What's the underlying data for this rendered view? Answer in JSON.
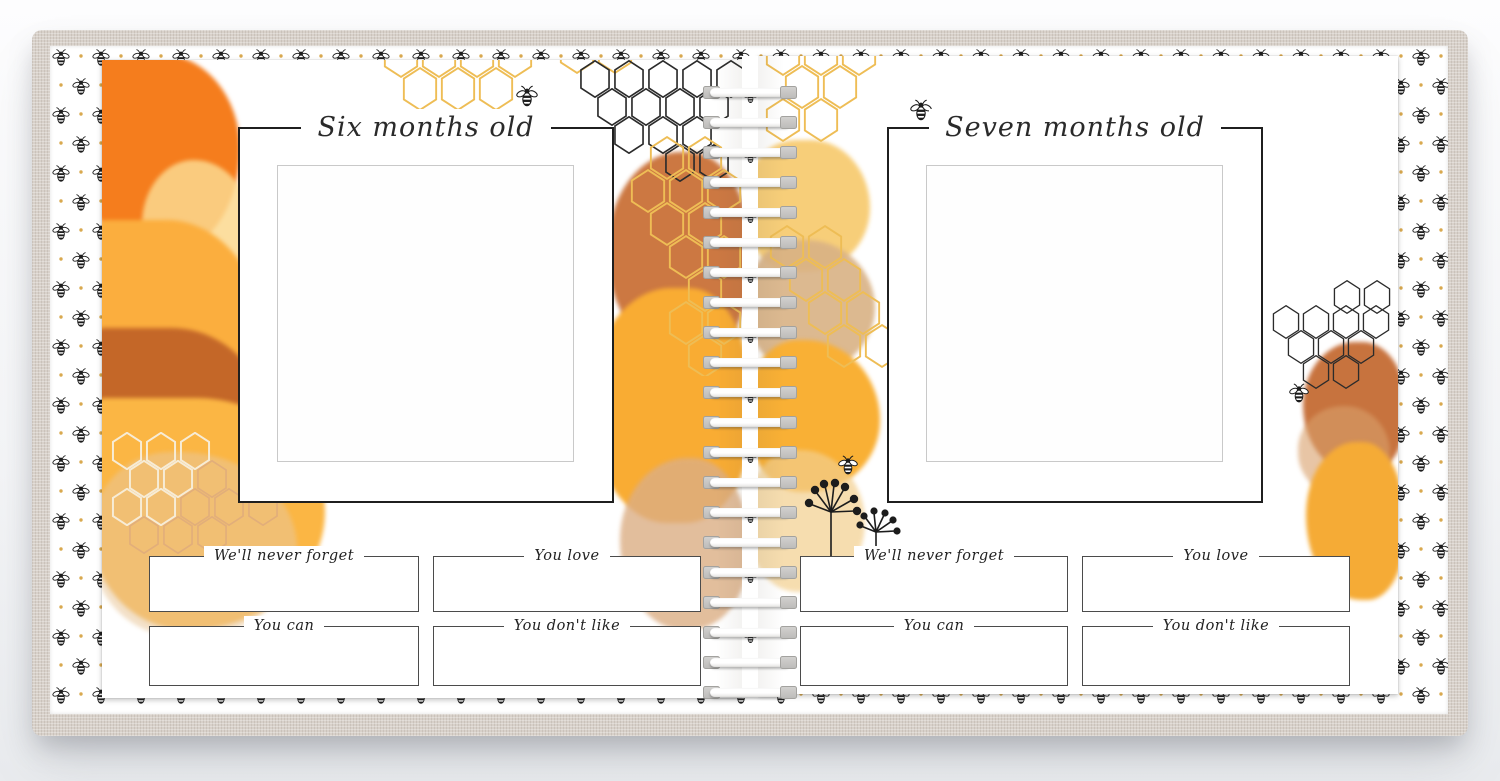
{
  "pages": {
    "left": {
      "title": "Six months old",
      "fields": [
        "We'll never forget",
        "You love",
        "You can",
        "You don't like"
      ]
    },
    "right": {
      "title": "Seven months old",
      "fields": [
        "We'll never forget",
        "You love",
        "You can",
        "You don't like"
      ]
    }
  },
  "decor": {
    "icons": [
      "bee-icon",
      "honeycomb-icon",
      "dandelion-icon",
      "spiral-binding"
    ],
    "colors": {
      "cover_linen": "#d8d1ca",
      "page_white": "#ffffff",
      "bee_black": "#1c1c1c",
      "honeycomb_gold": "#eebd55",
      "honeycomb_black": "#2b2b2b",
      "honeycomb_cream": "#f7ecd6",
      "honeycomb_tan": "#e2ae7a",
      "watercolor_orange": "#f57d1d",
      "watercolor_golden": "#fbb040",
      "watercolor_sienna": "#c06227",
      "watercolor_tan": "#d9b285",
      "accent_dot_gold": "#d9a94f"
    }
  }
}
